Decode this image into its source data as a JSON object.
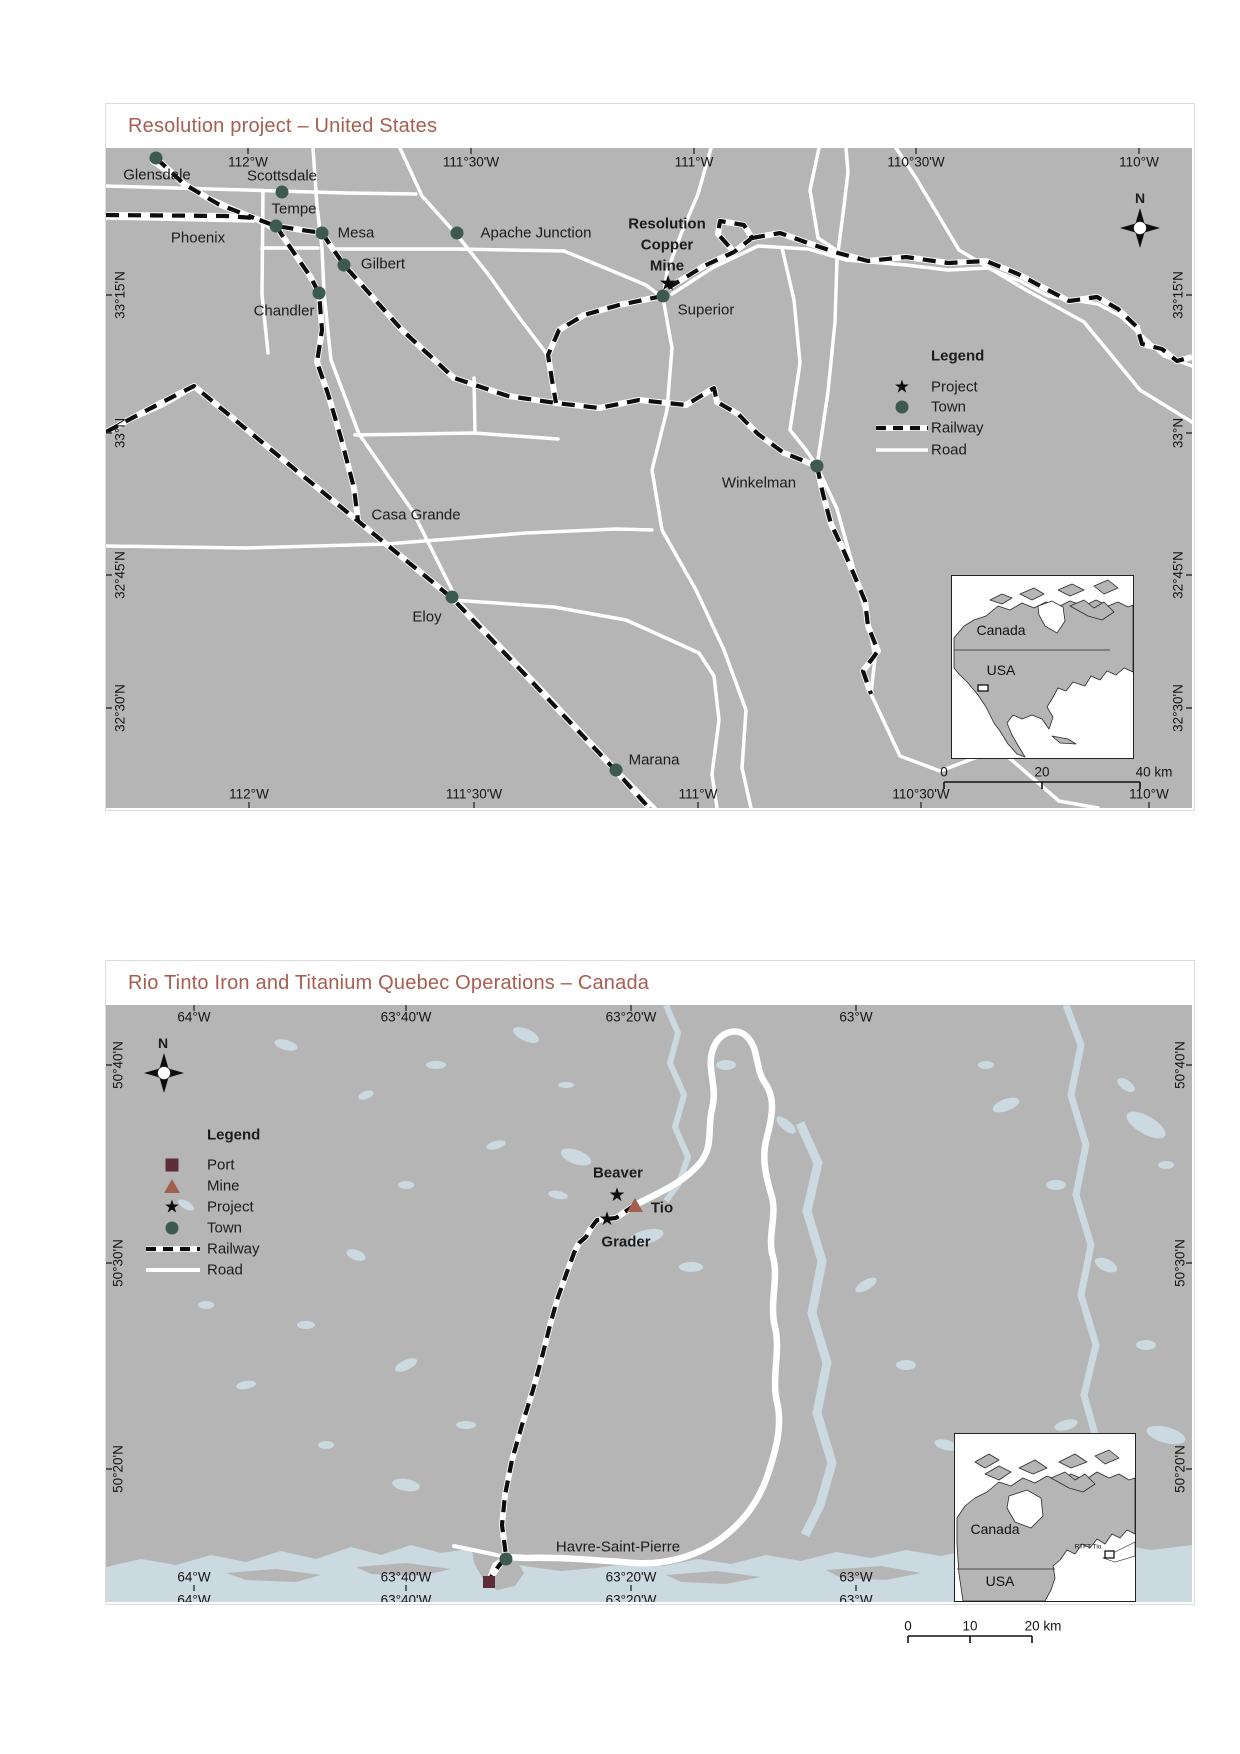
{
  "top_map": {
    "title": "Resolution project – United States",
    "north": "N",
    "lon_top": [
      "112°W",
      "111°30'W",
      "111°W",
      "110°30'W",
      "110°W"
    ],
    "lon_bottom": [
      "112°W",
      "111°30'W",
      "111°W",
      "110°30'W",
      "110°W"
    ],
    "lat_left": [
      "33°15'N",
      "33°N",
      "32°45'N",
      "32°30'N"
    ],
    "lat_right": [
      "33°15'N",
      "33°N",
      "32°45'N",
      "32°30'N"
    ],
    "towns": [
      "Glensdale",
      "Scottsdale",
      "Tempe",
      "Phoenix",
      "Mesa",
      "Apache Junction",
      "Gilbert",
      "Chandler",
      "Superior",
      "Winkelman",
      "Casa Grande",
      "Eloy",
      "Marana"
    ],
    "project_label": "Resolution\nCopper\nMine",
    "legend": {
      "title": "Legend",
      "project": "Project",
      "town": "Town",
      "railway": "Railway",
      "road": "Road"
    },
    "inset": {
      "canada": "Canada",
      "usa": "USA"
    },
    "scalebar": {
      "t0": "0",
      "t1": "20",
      "t2": "40 km"
    }
  },
  "bottom_map": {
    "title": "Rio Tinto Iron and Titanium Quebec Operations – Canada",
    "north": "N",
    "lon_top": [
      "64°W",
      "63°40'W",
      "63°20'W",
      "63°W"
    ],
    "lon_bottom": [
      "64°W",
      "63°40'W",
      "63°20'W",
      "63°W"
    ],
    "lon_bottom_cut": [
      "64°W",
      "63°40'W",
      "63°20'W",
      "63°W"
    ],
    "lat_left": [
      "50°40'N",
      "50°30'N",
      "50°20'N"
    ],
    "lat_right": [
      "50°40'N",
      "50°30'N",
      "50°20'N"
    ],
    "legend": {
      "title": "Legend",
      "port": "Port",
      "mine": "Mine",
      "project": "Project",
      "town": "Town",
      "railway": "Railway",
      "road": "Road"
    },
    "sites": {
      "beaver": "Beaver",
      "tio": "Tio",
      "grader": "Grader",
      "havre": "Havre-Saint-Pierre"
    },
    "inset": {
      "canada": "Canada",
      "usa": "USA",
      "rtft": "RTFT Tio"
    },
    "scalebar": {
      "t0": "0",
      "t1": "10",
      "t2": "20 km"
    }
  }
}
